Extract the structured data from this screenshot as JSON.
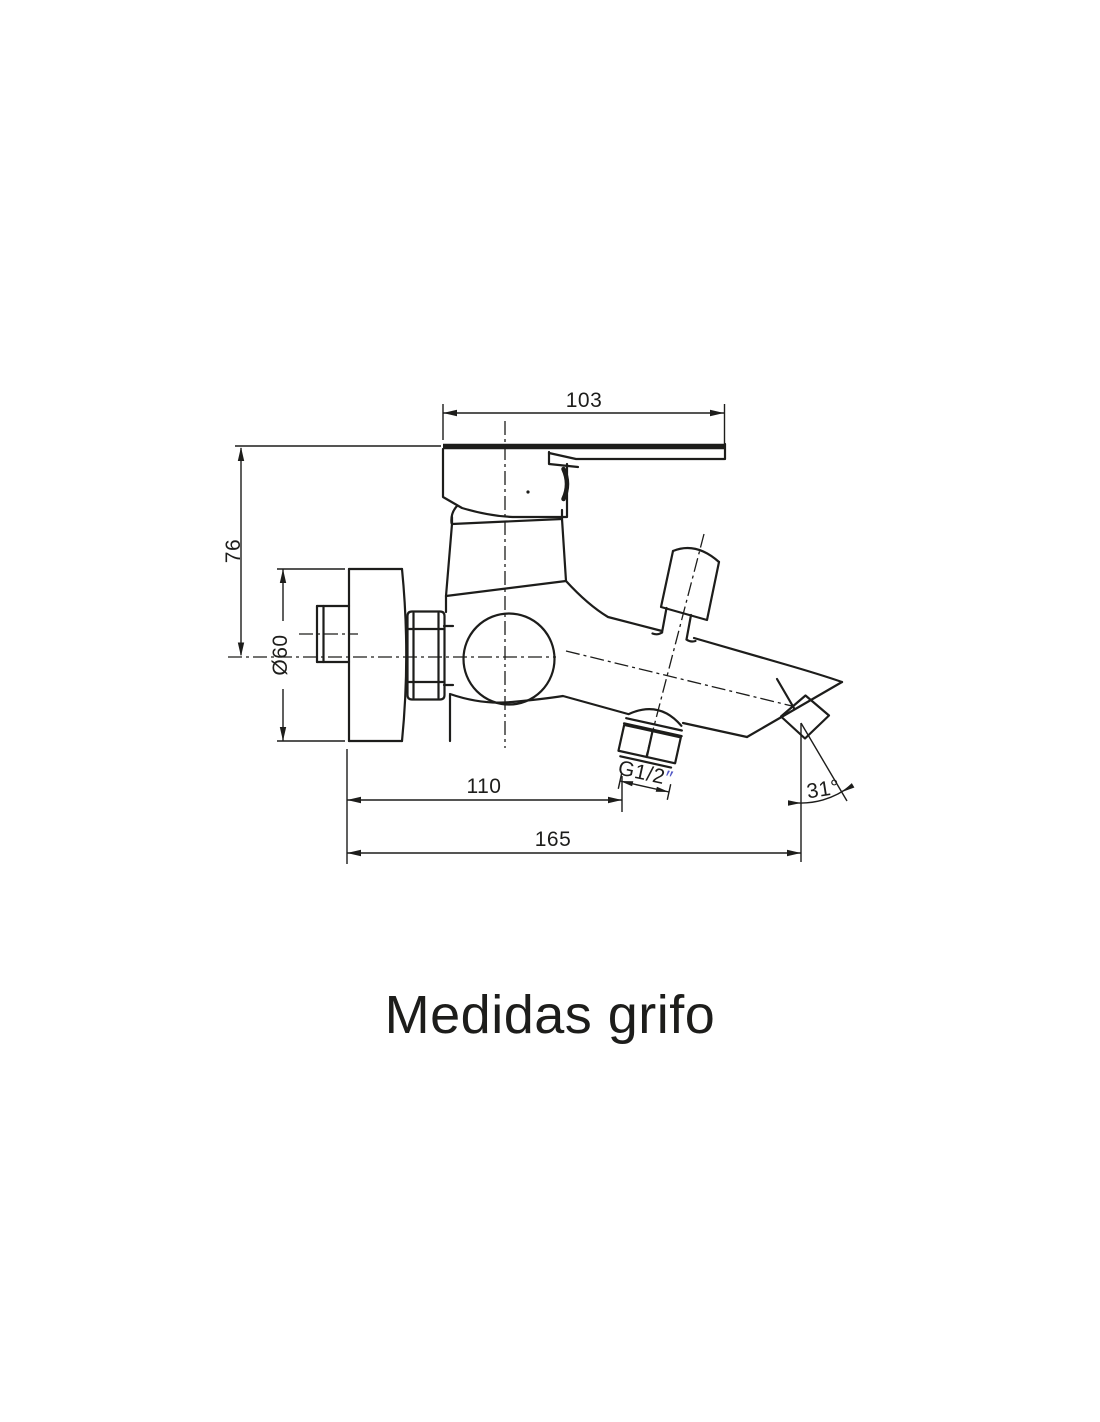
{
  "title": "Medidas grifo",
  "colors": {
    "line": "#1d1d1b",
    "accent": "#5157c5",
    "background": "#ffffff"
  },
  "dimensions": {
    "handle_width": "103",
    "handle_height": "76",
    "flange_diameter": "Ø60",
    "wall_to_outlet": "110",
    "total_length": "165",
    "spout_angle": "31°",
    "thread_label": "G1/2",
    "thread_quote": "″"
  }
}
